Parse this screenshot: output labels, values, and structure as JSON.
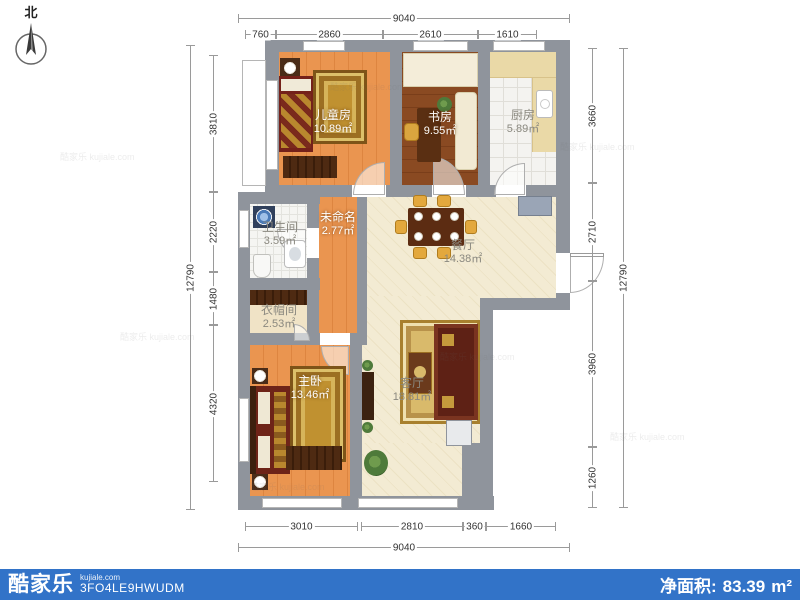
{
  "meta": {
    "compass_label": "北",
    "brand": "酷家乐",
    "brand_domain": "kujiale.com",
    "plan_code": "3FO4LE9HWUDM",
    "net_area_label": "净面积:",
    "net_area_value": "83.39",
    "net_area_unit": "m²",
    "watermark": "酷家乐 kujiale.com",
    "bar_color": "#3273c8",
    "wall_color": "#8f949c"
  },
  "rooms": {
    "children": {
      "name": "儿童房",
      "area": "10.89㎡"
    },
    "study": {
      "name": "书房",
      "area": "9.55㎡"
    },
    "kitchen": {
      "name": "厨房",
      "area": "5.89㎡"
    },
    "bathroom": {
      "name": "卫生间",
      "area": "3.59㎡"
    },
    "unnamed": {
      "name": "未命名",
      "area": "2.77㎡"
    },
    "dining": {
      "name": "餐厅",
      "area": "14.38㎡"
    },
    "cloakroom": {
      "name": "衣帽间",
      "area": "2.53㎡"
    },
    "master": {
      "name": "主卧",
      "area": "13.46㎡"
    },
    "living": {
      "name": "客厅",
      "area": "18.81㎡"
    }
  },
  "dimensions": {
    "top_total": "9040",
    "top_segments": [
      "760",
      "2860",
      "2610",
      "1610"
    ],
    "left_total": "12790",
    "left_segments": [
      "3810",
      "2220",
      "1480",
      "4320"
    ],
    "right_total": "12790",
    "right_segments": [
      "3660",
      "2710",
      "3960",
      "1260"
    ],
    "bottom_total": "9040",
    "bottom_segments": [
      "3010",
      "2810",
      "360",
      "1660"
    ]
  }
}
